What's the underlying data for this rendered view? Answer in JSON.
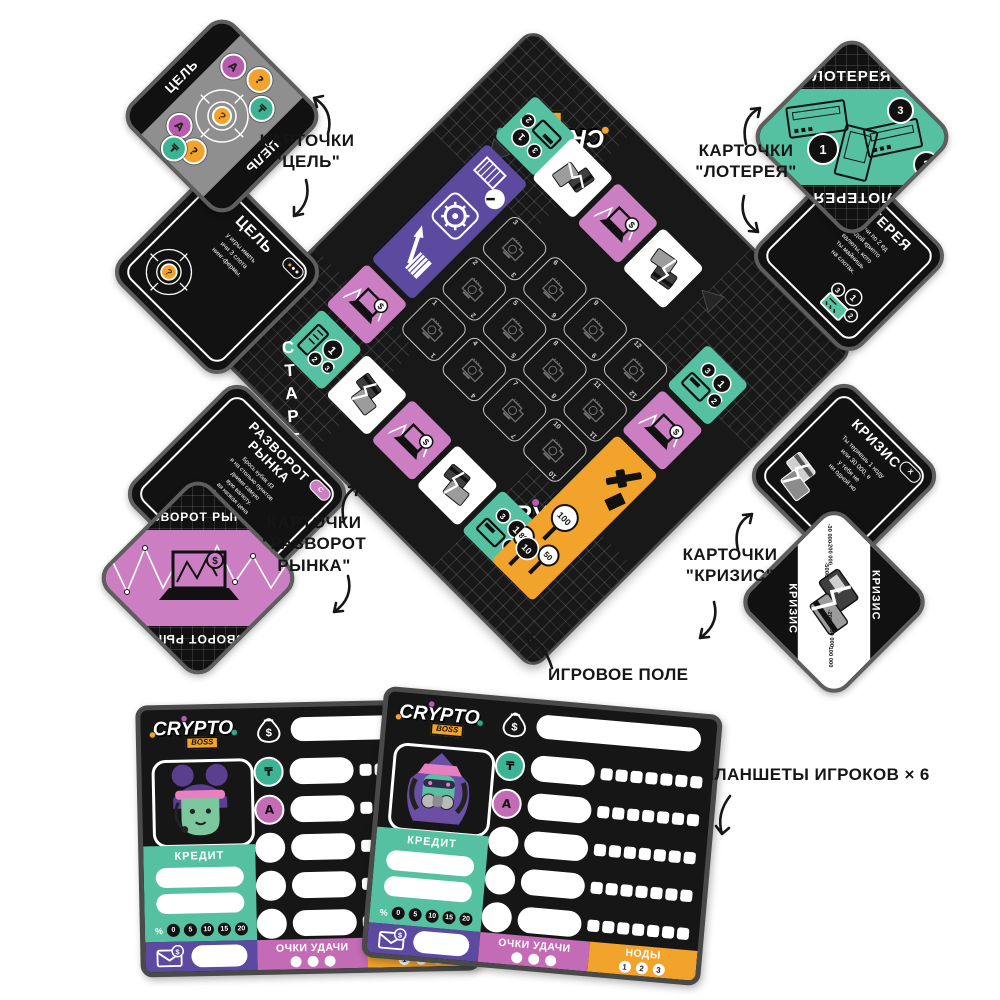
{
  "symbols": {
    "tenge": "₸",
    "a_coin": "А",
    "question": "?",
    "dollar": "$"
  },
  "logo": {
    "crypto": "CRYPTO",
    "boss": "BOSS"
  },
  "annotations": {
    "goal_l1": "КАРТОЧКИ",
    "goal_l2": "\"ЦЕЛЬ\"",
    "lottery_l1": "КАРТОЧКИ",
    "lottery_l2": "\"ЛОТЕРЕЯ\"",
    "market_l1": "КАРТОЧКИ",
    "market_l2": "\"РАЗВОРОТ",
    "market_l3": "РЫНКА\"",
    "crisis_l1": "КАРТОЧКИ",
    "crisis_l2": "\"КРИЗИС\"",
    "field": "ИГРОВОЕ ПОЛЕ",
    "players": "ПЛАНШЕТЫ ИГРОКОВ × 6"
  },
  "board": {
    "start": "СТАРТ",
    "slots": [
      "3",
      "6",
      "9",
      "12",
      "2",
      "5",
      "8",
      "11",
      "1",
      "4",
      "7",
      "10"
    ],
    "lottery_space": {
      "b1": "1",
      "b2": "2",
      "b3": "3"
    },
    "auction": {
      "v100": "100",
      "v10": "10",
      "v50": "50",
      "v80": "80"
    }
  },
  "cards": {
    "goal": {
      "back_title": "ЦЕЛЬ",
      "front_title": "ЦЕЛЬ",
      "front_text": [
        "у игры иметь",
        "ичи 3 слота",
        "нинг-фермы."
      ]
    },
    "lottery": {
      "back_title": "ЛОТЕРЕЯ",
      "front_title": "ЛОТЕРЕЯ",
      "front_text": [
        "Получи по 2 ед",
        "каждой крипто",
        "валюты, кото",
        "ты майнишь",
        "на слотах."
      ]
    },
    "market": {
      "back_title": "РАЗВОРОТ РЫНКА",
      "front_title1": "РАЗВОРОТ",
      "front_title2": "РЫНКА",
      "badge": "C",
      "front_text": [
        "Брось кубик d3",
        "и на столько пунктов",
        "дними самую",
        "вую валюту.",
        "ая низкая цена",
        "более валют –",
        "тся стоимость",
        "таких валют."
      ]
    },
    "crisis": {
      "back_title": "КРИЗИС",
      "front_title": "КРИЗИС",
      "badge": "X",
      "front_text": [
        "Ты теряешь 1 ноду",
        "или 30 000, е",
        "у тебя не",
        "ни одной но"
      ],
      "values_a": [
        "-30 000",
        "-200 000",
        "-5000"
      ],
      "values_b": [
        "-200",
        "-50 000",
        "-100 000"
      ]
    }
  },
  "player_board": {
    "credit": "КРЕДИТ",
    "percent_sign": "%",
    "percents": [
      "0",
      "5",
      "10",
      "15",
      "20"
    ],
    "luck": "ОЧКИ УДАЧИ",
    "nodes": "НОДЫ",
    "node_nums": [
      "1",
      "2",
      "3"
    ]
  },
  "colors": {
    "teal": "#56c1a0",
    "pink": "#cb7ec2",
    "purple": "#5b4aa0",
    "orange": "#f2a32b",
    "board_black": "#181818",
    "gray_card": "#8f8f8f"
  }
}
